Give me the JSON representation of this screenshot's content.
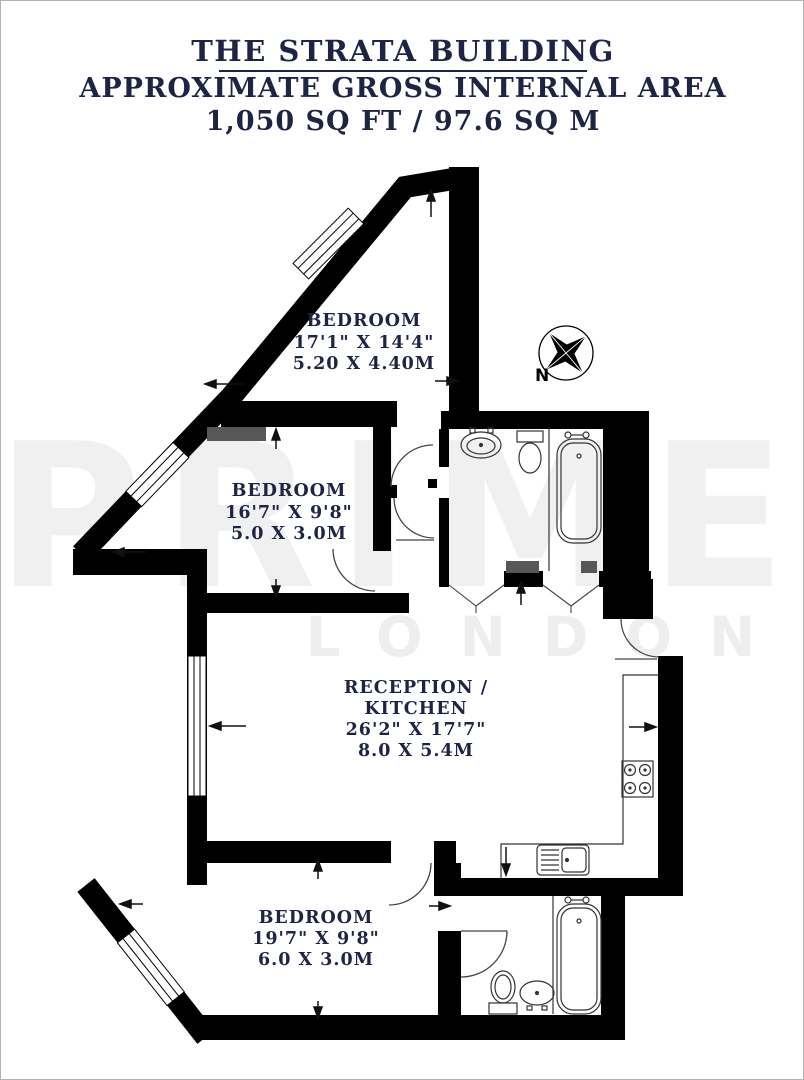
{
  "title": {
    "line1": "THE STRATA BUILDING",
    "line2": "APPROXIMATE GROSS INTERNAL AREA",
    "line3": "1,050 SQ FT / 97.6 SQ M"
  },
  "watermark": {
    "primary": "PRIME",
    "secondary": "LONDON"
  },
  "compass": {
    "north_label": "N"
  },
  "rooms": {
    "bedroom_top": {
      "label": "BEDROOM",
      "imperial": "17'1\" X 14'4\"",
      "metric": "5.20 X 4.40M"
    },
    "bedroom_middle": {
      "label": "BEDROOM",
      "imperial": "16'7\" X 9'8\"",
      "metric": "5.0 X 3.0M"
    },
    "reception": {
      "label_line1": "RECEPTION /",
      "label_line2": "KITCHEN",
      "imperial": "26'2\" X 17'7\"",
      "metric": "8.0 X 5.4M"
    },
    "bedroom_bottom": {
      "label": "BEDROOM",
      "imperial": "19'7\" X 9'8\"",
      "metric": "6.0 X 3.0M"
    }
  },
  "colors": {
    "text_navy": "#1e2444",
    "wall_black": "#000000",
    "watermark_gray": "#f0f0f0",
    "gray_wall_detail": "#575757"
  }
}
